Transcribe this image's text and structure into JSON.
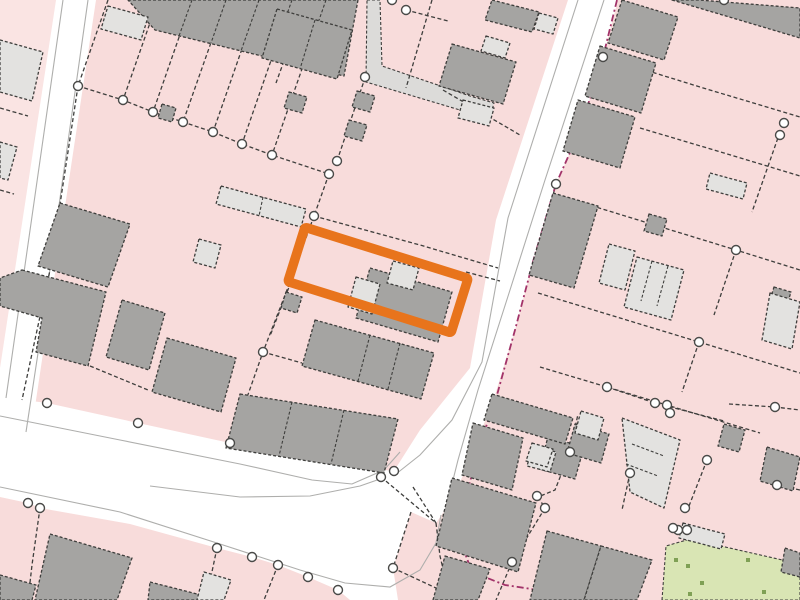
{
  "map": {
    "description": "cadastral-title-plan",
    "canvas": {
      "width": 800,
      "height": 600
    },
    "palette": {
      "parcel_pink": "#f8dcdb",
      "parcel_pink_light": "#fae4e3",
      "road_white": "#ffffff",
      "building_grey": "#a5a4a2",
      "building_light": "#e3e2e0",
      "walkway_grey": "#dcdbd9",
      "outline_dark": "#3e3e3c",
      "kerb_grey": "#aeaeac",
      "node_fill": "#ffffff",
      "node_ring": "#4a4a48",
      "highlight_orange": "#e8741c",
      "boundary_magenta": "#a23369",
      "green_space": "#d9e5b4",
      "green_dot": "#7fa055"
    },
    "highlight": {
      "name": "selected-plot-outline",
      "cx": 378,
      "cy": 280,
      "width": 171,
      "height": 57,
      "angle": 17.4,
      "stroke_width": 9.5
    },
    "parcels_light": [
      {
        "pts": "0,0 56,0 0,368"
      }
    ],
    "roads": [
      {
        "name": "road-northwest",
        "pts": "56,0 96,0 30,440 0,478 0,368"
      },
      {
        "name": "road-main-junction",
        "pts": "0,397 47,403 138,423 230,443 330,464 394,471 420,430 470,368 496,220 568,0 618,0 603,57 580,130 556,184 534,258 515,330 495,395 472,455 452,500 436,523 411,512 393,568 398,600 350,600 338,590 308,577 278,565 252,557 217,548 130,524 40,508 28,503 0,497"
      }
    ],
    "walkway": {
      "name": "footpath",
      "pts": "367,0 380,0 382,66 470,96 494,103 490,118 460,110 366,82"
    },
    "green": {
      "outline": "662,600 666,546 690,539 800,564 800,600",
      "dots": [
        [
          676,
          560
        ],
        [
          688,
          566
        ],
        [
          702,
          583
        ],
        [
          748,
          560
        ],
        [
          764,
          592
        ],
        [
          690,
          594
        ]
      ]
    },
    "kerb_lines": [
      {
        "pts": "63,0 6,398"
      },
      {
        "pts": "88,0 40,340 26,432"
      },
      {
        "pts": "0,416 120,440 240,464 312,480 352,484 384,470 400,452"
      },
      {
        "pts": "578,0 508,218 482,362 452,420 420,455 396,474"
      },
      {
        "pts": "604,0 545,180 510,290 478,390 458,460 448,500"
      },
      {
        "pts": "0,487 120,512 220,544 300,570 345,583 390,587 420,570 436,543 441,515"
      },
      {
        "pts": "150,486 240,497 310,496 360,486 383,478"
      }
    ],
    "boundary_lines": [
      {
        "pts": "108,0 78,86"
      },
      {
        "pts": "158,0 123,100"
      },
      {
        "pts": "192,0 153,112"
      },
      {
        "pts": "226,0 183,122"
      },
      {
        "pts": "259,0 213,132"
      },
      {
        "pts": "292,0 242,144"
      },
      {
        "pts": "326,0 272,155"
      },
      {
        "pts": "78,86 123,100 153,112 183,122 213,132 242,144 272,155 329,174"
      },
      {
        "pts": "78,86 50,270 22,400"
      },
      {
        "pts": "337,161 365,78"
      },
      {
        "pts": "329,174 314,216"
      },
      {
        "pts": "314,216 287,290 263,352 232,440"
      },
      {
        "pts": "314,216 420,245 498,268"
      },
      {
        "pts": "291,282 270,336"
      },
      {
        "pts": "466,272 500,281"
      },
      {
        "pts": "306,0 276,83"
      },
      {
        "pts": "432,0 406,88"
      },
      {
        "pts": "406,10 448,21"
      },
      {
        "pts": "443,90 520,135"
      },
      {
        "pts": "263,352 302,363"
      },
      {
        "pts": "90,366 148,390"
      },
      {
        "pts": "0,108 28,116"
      },
      {
        "pts": "0,190 14,194"
      },
      {
        "pts": "603,57 700,87 800,117"
      },
      {
        "pts": "640,128 724,153 800,176"
      },
      {
        "pts": "560,196 648,223 736,250 800,270"
      },
      {
        "pts": "538,293 620,318 699,342 800,373"
      },
      {
        "pts": "540,367 607,387 700,415 760,433"
      },
      {
        "pts": "780,132 752,212"
      },
      {
        "pts": "736,250 714,315"
      },
      {
        "pts": "699,342 682,392"
      },
      {
        "pts": "556,184 543,232"
      },
      {
        "pts": "607,387 655,403 724,421"
      },
      {
        "pts": "570,452 555,490 538,497"
      },
      {
        "pts": "538,497 545,508"
      },
      {
        "pts": "545,508 512,562"
      },
      {
        "pts": "512,562 496,600"
      },
      {
        "pts": "630,473 622,510"
      },
      {
        "pts": "707,460 689,506"
      },
      {
        "pts": "729,404 775,407 800,410"
      },
      {
        "pts": "777,485 800,490"
      },
      {
        "pts": "411,512 393,568 436,588"
      },
      {
        "pts": "381,477 436,523"
      },
      {
        "pts": "413,487 436,523"
      },
      {
        "pts": "436,523 440,556 448,590"
      },
      {
        "pts": "40,508 32,565 28,600"
      },
      {
        "pts": "217,548 206,600"
      },
      {
        "pts": "278,565 264,600"
      },
      {
        "pts": "570,452 578,414"
      }
    ],
    "magenta_boundary": {
      "pts": "617,0 603,57 580,130 556,184 534,258 515,330 497,395 478,450 466,498 460,540 472,572 505,585 538,590 560,600"
    },
    "buildings": [
      {
        "shade": "dark",
        "pts": "128,0 358,0 344,76 155,30",
        "inner": [
          "192,0 179,36",
          "226,0 211,43",
          "259,0 241,51",
          "292,0 271,59",
          "326,0 303,66"
        ]
      },
      {
        "shade": "dark",
        "pts": "277,9 352,30 337,79 262,58",
        "inner": [
          "315,20 300,69"
        ]
      },
      {
        "shade": "dark",
        "pts": "492,0 539,12 532,32 485,20"
      },
      {
        "shade": "dark",
        "pts": "452,44 516,62 503,104 439,86"
      },
      {
        "shade": "dark",
        "pts": "370,268 452,292 438,342 356,318"
      },
      {
        "shade": "dark",
        "pts": "315,320 434,353 421,399 302,366",
        "inner": [
          "370,335 358,381",
          "400,343 388,389"
        ]
      },
      {
        "shade": "dark",
        "pts": "240,394 398,419 384,473 226,448",
        "inner": [
          "292,402 279,456",
          "344,410 331,464"
        ]
      },
      {
        "shade": "dark",
        "pts": "60,203 130,224 108,287 38,266"
      },
      {
        "shade": "dark",
        "pts": "22,270 106,292 88,366 36,352 42,318 0,306 0,278"
      },
      {
        "shade": "dark",
        "pts": "122,300 165,313 149,370 106,357"
      },
      {
        "shade": "dark",
        "pts": "167,338 236,358 221,412 152,392"
      },
      {
        "shade": "dark",
        "pts": "50,534 132,558 117,600 35,600"
      },
      {
        "shade": "dark",
        "pts": "0,575 36,585 32,600 0,600"
      },
      {
        "shade": "dark",
        "pts": "150,582 205,596 203,600 148,600"
      },
      {
        "shade": "dark",
        "pts": "357,91 375,96 370,112 352,107"
      },
      {
        "shade": "dark",
        "pts": "349,120 367,125 362,141 344,136"
      },
      {
        "shade": "dark",
        "pts": "289,92 307,97 302,113 284,108"
      },
      {
        "shade": "dark",
        "pts": "286,292 302,297 297,313 281,308"
      },
      {
        "shade": "dark",
        "pts": "162,104 176,108 172,122 158,118"
      },
      {
        "shade": "dark",
        "pts": "622,0 678,17 664,60 608,43"
      },
      {
        "shade": "dark",
        "pts": "600,46 656,63 641,113 585,96"
      },
      {
        "shade": "dark",
        "pts": "578,100 635,117 620,168 563,151"
      },
      {
        "shade": "dark",
        "pts": "553,193 598,206 574,288 529,275"
      },
      {
        "shade": "dark",
        "pts": "672,0 800,38 800,8 699,0"
      },
      {
        "shade": "dark",
        "pts": "649,214 667,219 662,236 644,231"
      },
      {
        "shade": "dark",
        "pts": "774,287 791,292 787,305 770,300"
      },
      {
        "shade": "dark",
        "pts": "724,424 745,430 739,452 718,446"
      },
      {
        "shade": "dark",
        "pts": "548,437 584,447 575,479 539,469"
      },
      {
        "shade": "dark",
        "pts": "575,424 609,434 601,463 567,453"
      },
      {
        "shade": "dark",
        "pts": "767,447 800,457 793,491 760,481"
      },
      {
        "shade": "dark",
        "pts": "547,531 601,546 584,600 530,600"
      },
      {
        "shade": "dark",
        "pts": "601,546 652,560 637,600 584,600"
      },
      {
        "shade": "dark",
        "pts": "785,548 800,553 800,577 781,572"
      },
      {
        "shade": "dark",
        "pts": "492,394 573,418 565,444 484,420"
      },
      {
        "shade": "dark",
        "pts": "473,423 523,438 512,490 462,475"
      },
      {
        "shade": "dark",
        "pts": "452,478 536,503 518,572 436,546"
      },
      {
        "shade": "dark",
        "pts": "445,556 490,569 478,600 433,600"
      },
      {
        "shade": "light",
        "pts": "108,6 148,17 141,40 101,29"
      },
      {
        "shade": "light",
        "pts": "539,13 558,18 553,34 534,29"
      },
      {
        "shade": "light",
        "pts": "463,100 494,108 489,126 458,118"
      },
      {
        "shade": "light",
        "pts": "486,36 510,43 505,58 481,51"
      },
      {
        "shade": "light",
        "pts": "221,186 306,209 301,227 216,204",
        "inner": [
          "263,197 259,216"
        ]
      },
      {
        "shade": "light",
        "pts": "199,239 221,245 215,268 193,262"
      },
      {
        "shade": "light",
        "pts": "356,277 380,284 372,314 348,307"
      },
      {
        "shade": "light",
        "pts": "393,261 419,268 413,290 387,283"
      },
      {
        "shade": "light",
        "pts": "609,244 635,251 625,290 599,283"
      },
      {
        "shade": "light",
        "pts": "637,257 684,270 671,320 624,307",
        "inner": [
          "652,261 641,301",
          "668,266 657,306"
        ]
      },
      {
        "shade": "light",
        "pts": "770,293 800,302 792,349 762,340"
      },
      {
        "shade": "light",
        "pts": "710,173 747,183 743,199 706,189"
      },
      {
        "shade": "light",
        "pts": "622,418 680,440 664,508 630,492",
        "inner": [
          "632,444 664,456",
          "626,464 658,476"
        ]
      },
      {
        "shade": "light",
        "pts": "533,446 556,452 550,472 527,466"
      },
      {
        "shade": "light",
        "pts": "683,523 725,534 721,549 679,538"
      },
      {
        "shade": "light",
        "pts": "204,572 231,580 224,600 197,600"
      },
      {
        "shade": "light",
        "pts": "0,40 43,52 32,101 0,92"
      },
      {
        "shade": "light",
        "pts": "0,142 17,147 8,180 0,178"
      },
      {
        "shade": "light",
        "pts": "581,411 604,418 598,440 575,433"
      },
      {
        "shade": "light",
        "pts": "532,443 553,449 547,467 526,461"
      }
    ],
    "nodes": [
      [
        78,
        86
      ],
      [
        123,
        100
      ],
      [
        153,
        112
      ],
      [
        183,
        122
      ],
      [
        213,
        132
      ],
      [
        242,
        144
      ],
      [
        272,
        155
      ],
      [
        337,
        161
      ],
      [
        329,
        174
      ],
      [
        365,
        77
      ],
      [
        392,
        0
      ],
      [
        406,
        10
      ],
      [
        314,
        216
      ],
      [
        263,
        352
      ],
      [
        47,
        403
      ],
      [
        138,
        423
      ],
      [
        230,
        443
      ],
      [
        381,
        477
      ],
      [
        394,
        471
      ],
      [
        28,
        503
      ],
      [
        40,
        508
      ],
      [
        217,
        548
      ],
      [
        252,
        557
      ],
      [
        278,
        565
      ],
      [
        308,
        577
      ],
      [
        338,
        590
      ],
      [
        393,
        568
      ],
      [
        603,
        57
      ],
      [
        556,
        184
      ],
      [
        724,
        0
      ],
      [
        784,
        123
      ],
      [
        780,
        135
      ],
      [
        736,
        250
      ],
      [
        699,
        342
      ],
      [
        607,
        387
      ],
      [
        655,
        403
      ],
      [
        667,
        405
      ],
      [
        670,
        413
      ],
      [
        570,
        452
      ],
      [
        630,
        473
      ],
      [
        707,
        460
      ],
      [
        537,
        496
      ],
      [
        545,
        508
      ],
      [
        685,
        508
      ],
      [
        678,
        530
      ],
      [
        775,
        407
      ],
      [
        777,
        485
      ],
      [
        673,
        528
      ],
      [
        687,
        530
      ],
      [
        512,
        562
      ]
    ]
  }
}
